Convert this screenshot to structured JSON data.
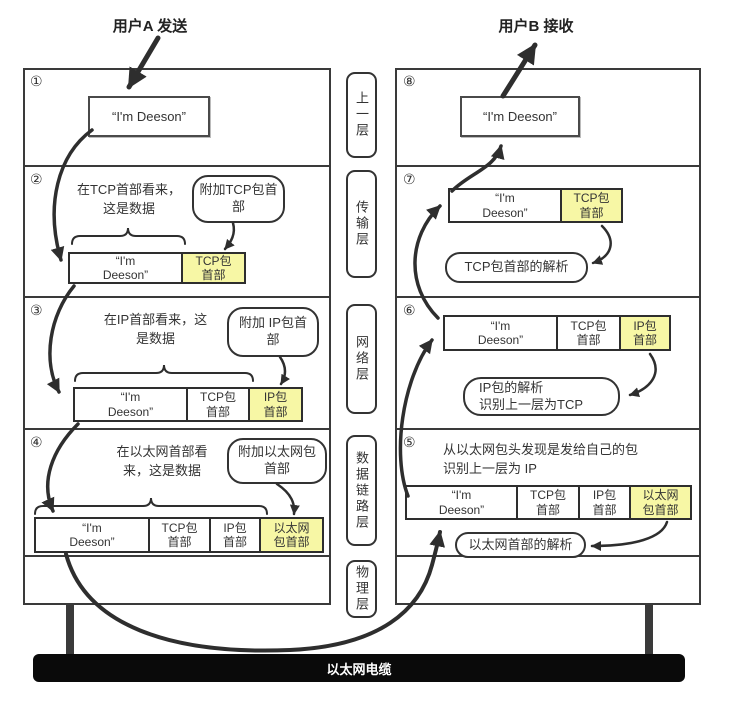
{
  "title": {
    "sender": "用户A 发送",
    "receiver": "用户B 接收"
  },
  "colors": {
    "highlight": "#f7f7a5",
    "line": "#2e2e2e",
    "cable_bg": "#0a0a0a",
    "cable_text": "#ffffff"
  },
  "layers": {
    "items": [
      "上一层",
      "传输层",
      "网络层",
      "数据链路层",
      "物理层"
    ]
  },
  "cable": {
    "label": "以太网电缆"
  },
  "left": {
    "rows": [
      {
        "num": "①",
        "message": "“I'm Deeson”"
      },
      {
        "num": "②",
        "note": "在TCP首部看来，\n这是数据",
        "bubble": "附加TCP包首\n部",
        "packet": [
          {
            "label": "“I'm\nDeeson”",
            "highlight": false
          },
          {
            "label": "TCP包\n首部",
            "highlight": true
          }
        ]
      },
      {
        "num": "③",
        "note": "在IP首部看来，这\n是数据",
        "bubble": "附加 IP包首\n部",
        "packet": [
          {
            "label": "“I'm\nDeeson”",
            "highlight": false
          },
          {
            "label": "TCP包\n首部",
            "highlight": false
          },
          {
            "label": "IP包\n首部",
            "highlight": true
          }
        ]
      },
      {
        "num": "④",
        "note": "在以太网首部看\n来，这是数据",
        "bubble": "附加以太网包\n首部",
        "packet": [
          {
            "label": "“I'm\nDeeson”",
            "highlight": false
          },
          {
            "label": "TCP包\n首部",
            "highlight": false
          },
          {
            "label": "IP包\n首部",
            "highlight": false
          },
          {
            "label": "以太网\n包首部",
            "highlight": true
          }
        ]
      }
    ]
  },
  "right": {
    "rows": [
      {
        "num": "⑧",
        "message": "“I'm Deeson”"
      },
      {
        "num": "⑦",
        "bubble": "TCP包首部的解析",
        "packet": [
          {
            "label": "“I'm\nDeeson”",
            "highlight": false
          },
          {
            "label": "TCP包\n首部",
            "highlight": true
          }
        ]
      },
      {
        "num": "⑥",
        "bubble": "IP包的解析\n识别上一层为TCP",
        "packet": [
          {
            "label": "“I'm\nDeeson”",
            "highlight": false
          },
          {
            "label": "TCP包\n首部",
            "highlight": false
          },
          {
            "label": "IP包\n首部",
            "highlight": true
          }
        ]
      },
      {
        "num": "⑤",
        "note": "从以太网包头发现是发给自己的包\n识别上一层为 IP",
        "bubble": "以太网首部的解析",
        "packet": [
          {
            "label": "“I'm\nDeeson”",
            "highlight": false
          },
          {
            "label": "TCP包\n首部",
            "highlight": false
          },
          {
            "label": "IP包\n首部",
            "highlight": false
          },
          {
            "label": "以太网\n包首部",
            "highlight": true
          }
        ]
      }
    ]
  }
}
